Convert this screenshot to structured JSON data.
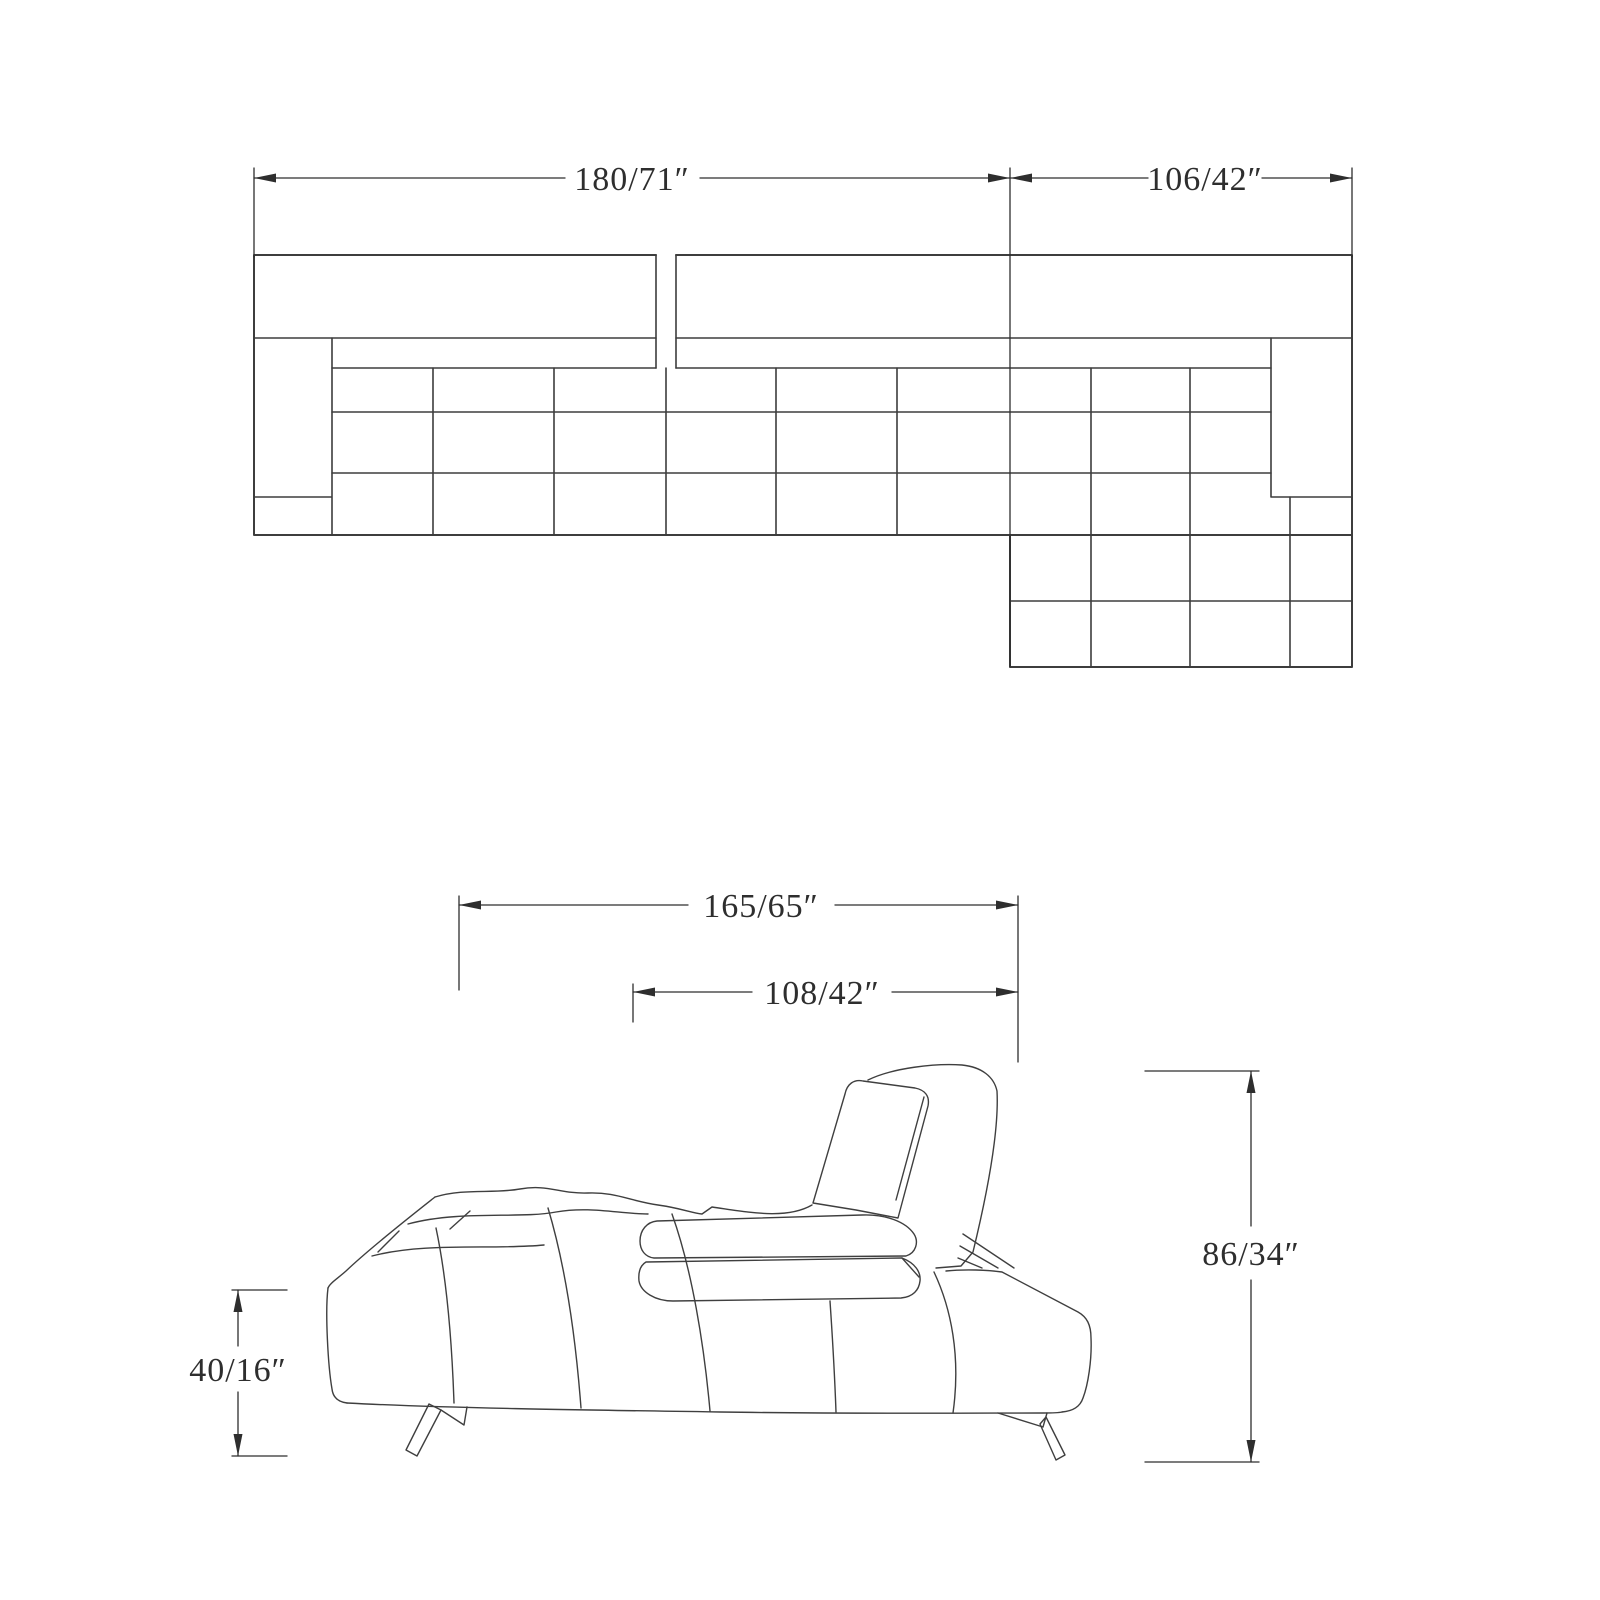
{
  "canvas": {
    "background": "#ffffff",
    "plan_line_color": "#3d3d3d",
    "side_line_color": "#3f3f3f",
    "dim_color": "#2e2e2e"
  },
  "top_view": {
    "name": "sectional-sofa-plan-view",
    "dim_total_width": "180/71″",
    "dim_chaise_width": "106/42″"
  },
  "side_view": {
    "name": "sofa-side-elevation-view",
    "dim_overall_depth": "165/65″",
    "dim_seat_depth": "108/42″",
    "dim_overall_height": "86/34″",
    "dim_seat_height": "40/16″"
  }
}
